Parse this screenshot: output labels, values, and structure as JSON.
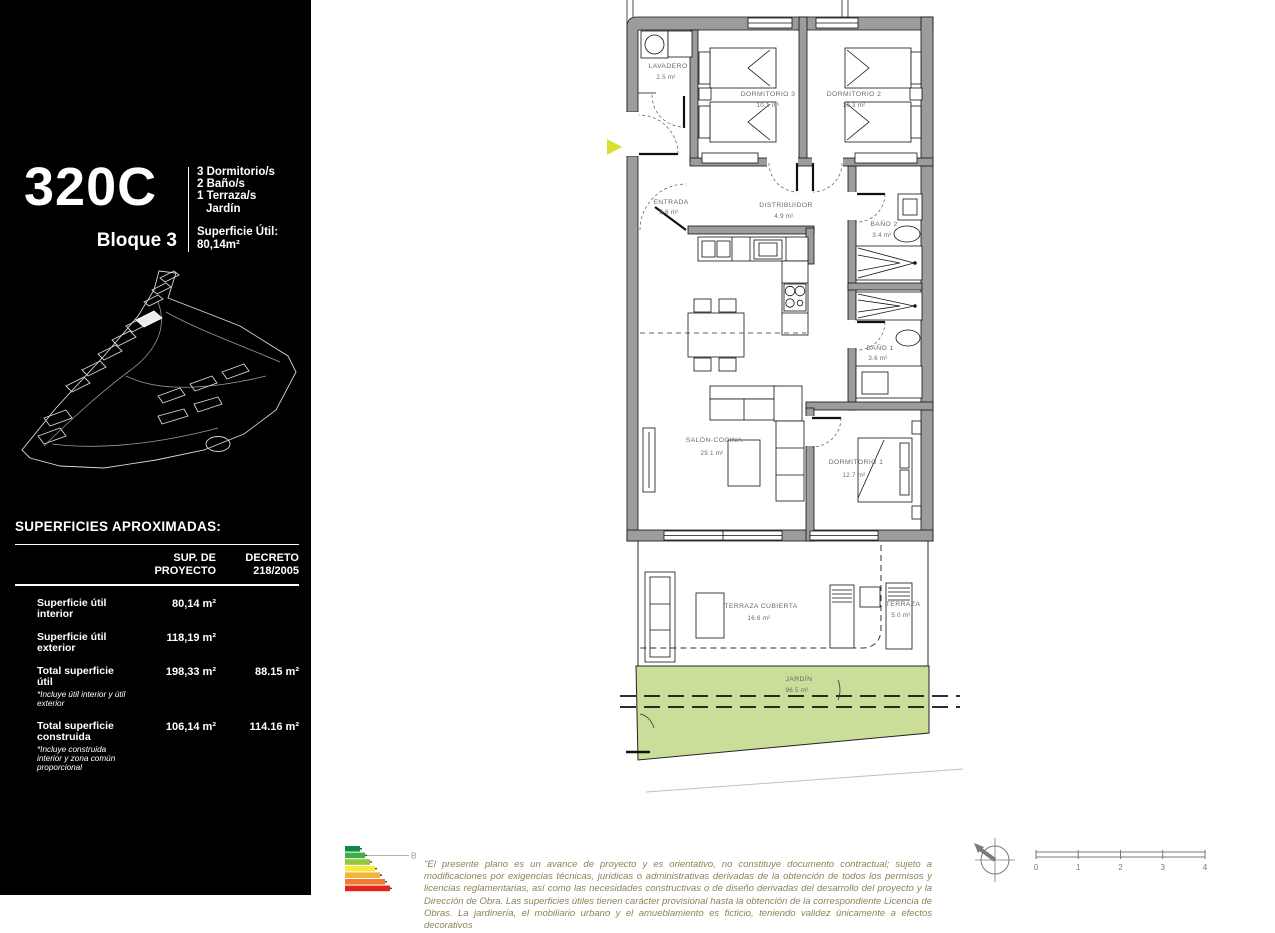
{
  "unit": {
    "id": "320C",
    "block": "Bloque 3",
    "specs": [
      "3 Dormitorio/s",
      "2 Baño/s",
      "1 Terraza/s",
      "Jardín"
    ],
    "surface_label": "Superficie Útil:",
    "surface_value": "80,14m²"
  },
  "areas_table": {
    "title": "SUPERFICIES APROXIMADAS:",
    "col_proyecto_l1": "SUP. DE",
    "col_proyecto_l2": "PROYECTO",
    "col_decreto_l1": "DECRETO",
    "col_decreto_l2": "218/2005",
    "rows": [
      {
        "label": "Superficie útil interior",
        "note": "",
        "proyecto": "80,14 m²",
        "decreto": ""
      },
      {
        "label": "Superficie útil exterior",
        "note": "",
        "proyecto": "118,19 m²",
        "decreto": ""
      },
      {
        "label": "Total superficie útil",
        "note": "*Incluye útil interior y útil exterior",
        "proyecto": "198,33 m²",
        "decreto": "88.15 m²"
      },
      {
        "label": "Total superficie construida",
        "note": "*Incluye construida interior y zona común proporcional",
        "proyecto": "106,14 m²",
        "decreto": "114.16 m²"
      }
    ]
  },
  "floorplan": {
    "rooms": {
      "lavadero": {
        "name": "LAVADERO",
        "area": "2.5 m²"
      },
      "dormitorio3": {
        "name": "DORMITORIO 3",
        "area": "10.1 m²"
      },
      "dormitorio2": {
        "name": "DORMITORIO 2",
        "area": "10.3 m²"
      },
      "entrada": {
        "name": "ENTRADA",
        "area": "3.6 m²"
      },
      "distribuidor": {
        "name": "DISTRIBUIDOR",
        "area": "4.9 m²"
      },
      "bano2": {
        "name": "BAÑO 2",
        "area": "3.4 m²"
      },
      "bano1": {
        "name": "BAÑO 1",
        "area": "3.6 m²"
      },
      "salon": {
        "name": "SALÓN-COCINA",
        "area": "29.1 m²"
      },
      "dormitorio1": {
        "name": "DORMITORIO 1",
        "area": "12.7 m²"
      },
      "terraza_cubierta": {
        "name": "TERRAZA CUBIERTA",
        "area": "16.6 m²"
      },
      "terraza": {
        "name": "TERRAZA",
        "area": "5.0 m²"
      },
      "jardin": {
        "name": "JARDÍN",
        "area": "96.5 m²"
      }
    }
  },
  "footer": {
    "energy_rating": "B",
    "disclaimer": "\"El presente plano es un avance de proyecto y es orientativo, no constituye documento contractual; sujeto a modificaciones por exigencias técnicas, jurídicas o administrativas derivadas de la obtención de todos los permisos y licencias reglamentarias, así como las necesidades constructivas o de diseño derivadas del desarrollo del proyecto y la Dirección de Obra. Las superficies útiles tienen carácter provisional hasta la obtención de la correspondiente Licencia de Obras. La jardinería, el mobiliario urbano y el amueblamiento es ficticio, teniendo validez únicamente a efectos decorativos",
    "scale_ticks": [
      "0",
      "1",
      "2",
      "3",
      "4"
    ]
  },
  "colors": {
    "panel_bg": "#000000",
    "wall_fill": "#9c9c9c",
    "garden_fill": "#cadd99",
    "entrance_arrow": "#d9e034",
    "label_text": "#6a6a6a",
    "energy_scale": [
      "#0a8f42",
      "#3fae49",
      "#93c83d",
      "#f7ea3b",
      "#f5b33a",
      "#ef7d2f",
      "#e2231a"
    ]
  }
}
